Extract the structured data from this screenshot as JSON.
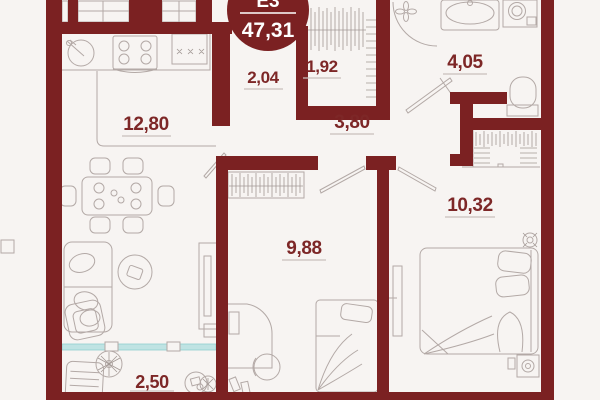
{
  "plan": {
    "badge": {
      "type_label": "Е3",
      "total_area": "47,31"
    },
    "rooms": [
      {
        "id": "kitchen-living-room",
        "area": "12,80"
      },
      {
        "id": "corridor",
        "area": "2,04"
      },
      {
        "id": "closet",
        "area": "1,92"
      },
      {
        "id": "hallway",
        "area": "3,80"
      },
      {
        "id": "bathroom",
        "area": "4,05"
      },
      {
        "id": "bedroom-right",
        "area": "10,32"
      },
      {
        "id": "bedroom-middle",
        "area": "9,88"
      },
      {
        "id": "balcony",
        "area": "2,50"
      }
    ],
    "colors": {
      "wall": "#7b2122",
      "label": "#7d2727",
      "glazing": "#bfe3e3",
      "furniture_line": "#b3a9a6",
      "background": "#f7f4f2"
    }
  }
}
